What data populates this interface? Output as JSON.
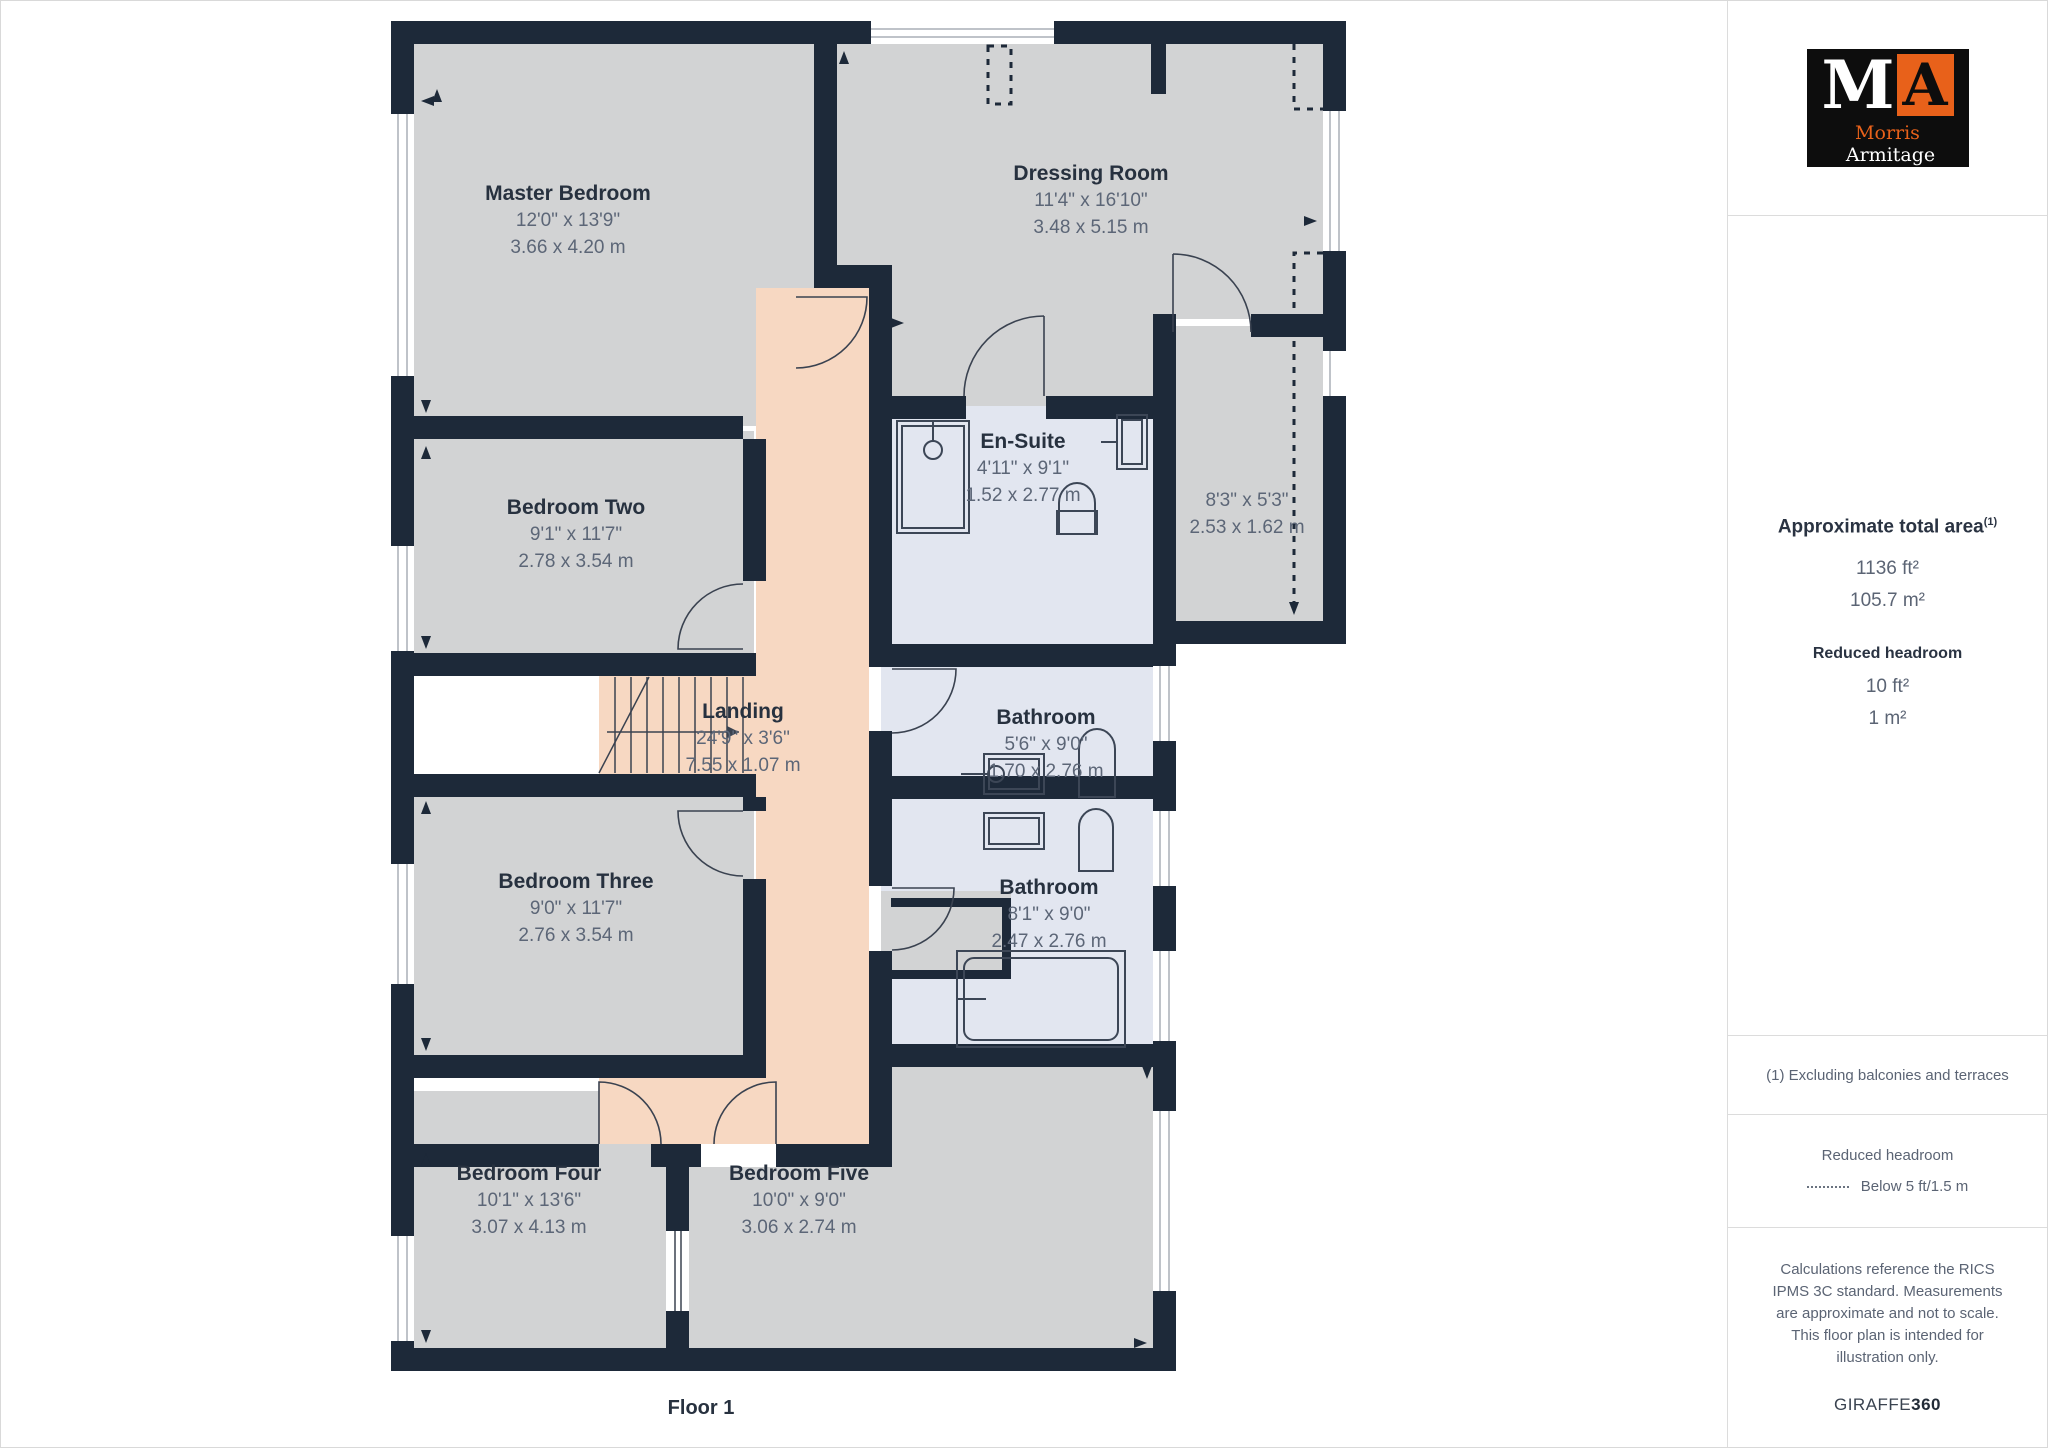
{
  "floor_label": "Floor 1",
  "rooms": {
    "master": {
      "name": "Master Bedroom",
      "imperial": "12'0\" x 13'9\"",
      "metric": "3.66 x 4.20 m"
    },
    "dressing": {
      "name": "Dressing Room",
      "imperial": "11'4\" x 16'10\"",
      "metric": "3.48 x 5.15 m"
    },
    "ensuite": {
      "name": "En-Suite",
      "imperial": "4'11\" x 9'1\"",
      "metric": "1.52 x 2.77 m"
    },
    "store": {
      "imperial": "8'3\" x 5'3\"",
      "metric": "2.53 x 1.62 m"
    },
    "bedroom2": {
      "name": "Bedroom Two",
      "imperial": "9'1\" x 11'7\"",
      "metric": "2.78 x 3.54 m"
    },
    "landing": {
      "name": "Landing",
      "imperial": "24'9\" x 3'6\"",
      "metric": "7.55 x 1.07 m"
    },
    "bathroom1": {
      "name": "Bathroom",
      "imperial": "5'6\" x 9'0\"",
      "metric": "1.70 x 2.76 m"
    },
    "bedroom3": {
      "name": "Bedroom Three",
      "imperial": "9'0\" x 11'7\"",
      "metric": "2.76 x 3.54 m"
    },
    "bathroom2": {
      "name": "Bathroom",
      "imperial": "8'1\" x 9'0\"",
      "metric": "2.47 x 2.76 m"
    },
    "bedroom4": {
      "name": "Bedroom Four",
      "imperial": "10'1\" x 13'6\"",
      "metric": "3.07 x 4.13 m"
    },
    "bedroom5": {
      "name": "Bedroom Five",
      "imperial": "10'0\" x 9'0\"",
      "metric": "3.06 x 2.74 m"
    }
  },
  "sidebar": {
    "logo": {
      "letter_m": "M",
      "letter_a": "A",
      "name_first": "Morris",
      "name_last": "Armitage"
    },
    "area": {
      "title": "Approximate total area",
      "title_superscript": "(1)",
      "imperial": "1136 ft²",
      "metric": "105.7 m²",
      "reduced_title": "Reduced headroom",
      "reduced_imperial": "10 ft²",
      "reduced_metric": "1 m²"
    },
    "footnote": "(1) Excluding balconies and terraces",
    "legend": {
      "title": "Reduced headroom",
      "label": "Below 5 ft/1.5 m"
    },
    "disclaimer": "Calculations reference the RICS IPMS 3C standard. Measurements are approximate and not to scale. This floor plan is intended for illustration only.",
    "brand": {
      "text": "GIRAFFE",
      "suffix": "360"
    }
  },
  "colors": {
    "wall": "#1d2939",
    "room_gray": "#d2d3d4",
    "wet_room": "#e2e6f0",
    "hallway": "#f7d8c2",
    "accent_orange": "#e8611a"
  }
}
